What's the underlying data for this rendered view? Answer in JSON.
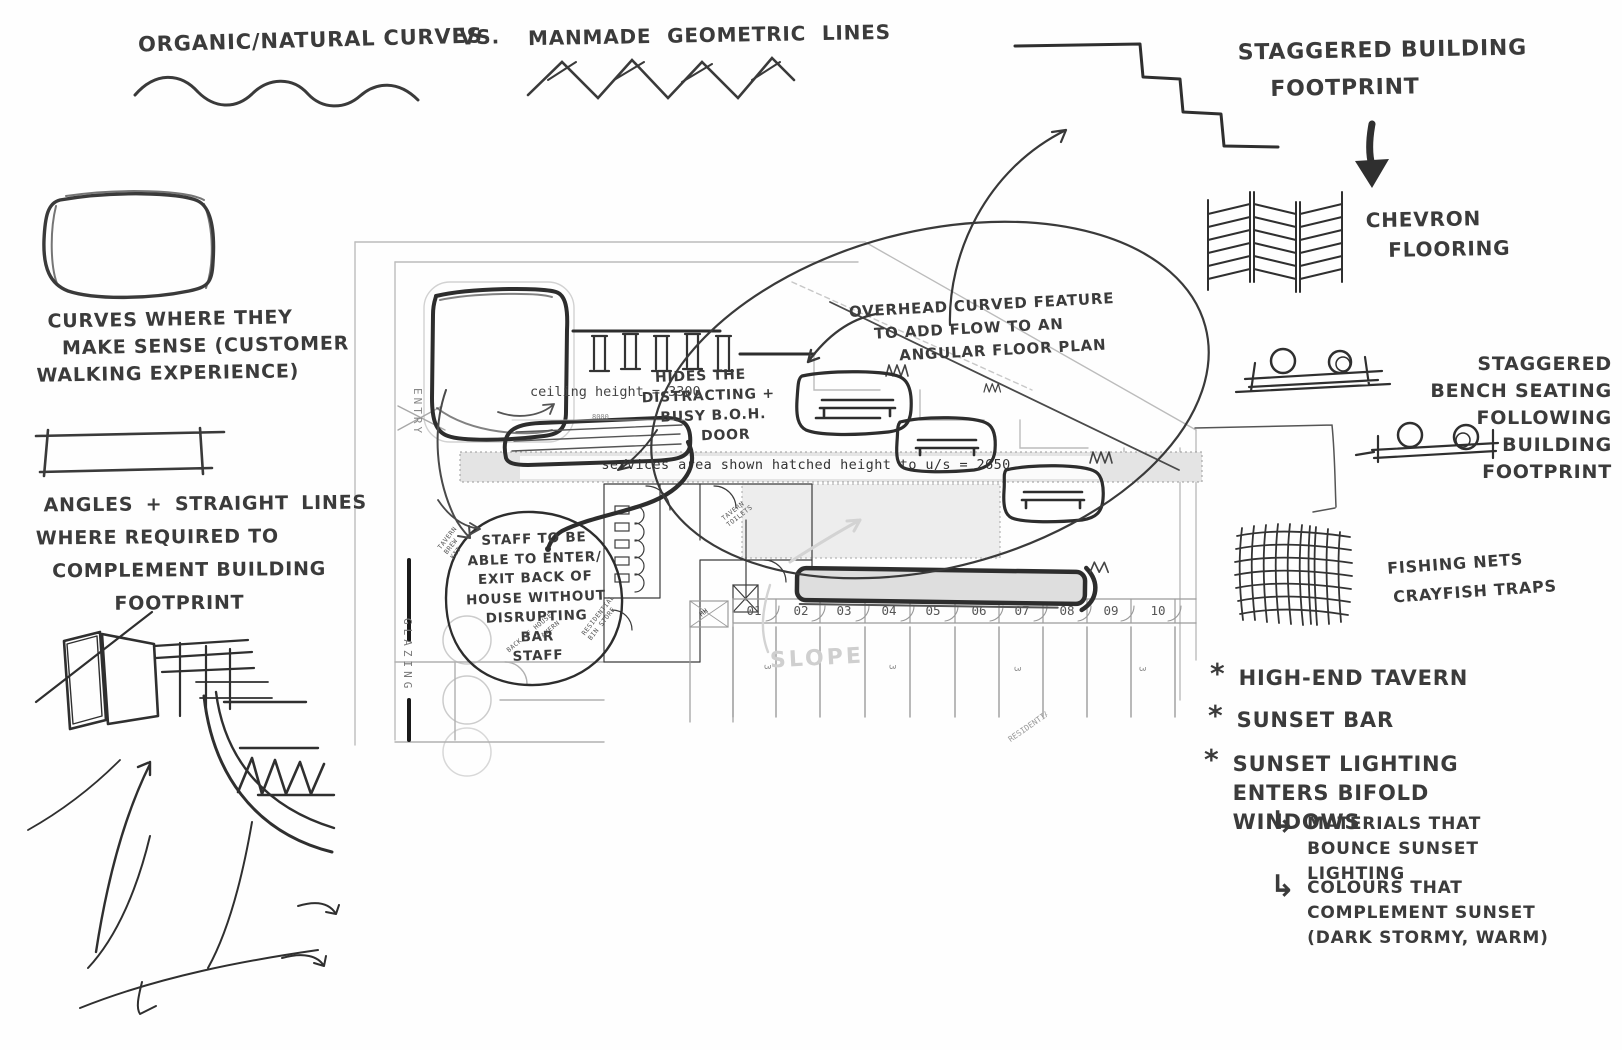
{
  "header": {
    "organic": "ORGANIC/NATURAL CURVES",
    "vs": "VS.",
    "manmade": "MANMADE GEOMETRIC LINES"
  },
  "left": {
    "curves_lines": [
      "CURVES WHERE THEY",
      "MAKE SENSE (CUSTOMER",
      "WALKING EXPERIENCE)"
    ],
    "angles_lines": [
      "ANGLES + STRAIGHT LINES",
      "WHERE REQUIRED TO",
      "COMPLEMENT BUILDING",
      "FOOTPRINT"
    ]
  },
  "right": {
    "staggered_building_lines": [
      "STAGGERED BUILDING",
      "FOOTPRINT"
    ],
    "chevron_lines": [
      "CHEVRON",
      "FLOORING"
    ],
    "bench_lines": [
      "STAGGERED",
      "BENCH SEATING",
      "FOLLOWING",
      "BUILDING",
      "FOOTPRINT"
    ],
    "nets_lines": [
      "FISHING NETS",
      "CRAYFISH TRAPS"
    ],
    "bullets": [
      {
        "marker": "*",
        "text": "HIGH-END TAVERN"
      },
      {
        "marker": "*",
        "text": "SUNSET BAR"
      },
      {
        "marker": "*",
        "text": "SUNSET LIGHTING ENTERS BIFOLD WINDOWS"
      }
    ],
    "sub_bullets": [
      {
        "marker": "↳",
        "text": "MATERIALS THAT BOUNCE SUNSET LIGHTING"
      },
      {
        "marker": "↳",
        "text": "COLOURS THAT COMPLEMENT SUNSET (DARK STORMY, WARM)"
      }
    ]
  },
  "annotations": {
    "overhead_lines": [
      "OVERHEAD CURVED FEATURE",
      "TO ADD FLOW TO AN",
      "ANGULAR FLOOR PLAN"
    ],
    "hides_lines": [
      "HIDES THE",
      "DISTRACTING +",
      "BUSY B.O.H.",
      "DOOR"
    ],
    "staff_lines": [
      "STAFF TO BE",
      "ABLE TO ENTER/",
      "EXIT BACK OF",
      "HOUSE WITHOUT",
      "DISRUPTING",
      "BAR",
      "STAFF"
    ]
  },
  "plan": {
    "ceiling_height": "ceiling height = 3300",
    "services_note": "services area shown hatched height to u/s = 2650",
    "dimension": "8000",
    "entry": "ENTRY",
    "glazing": "GLAZING",
    "slope": "SLOPE",
    "tavern_toilets_lines": [
      "TAVERN",
      "TOILETS"
    ],
    "tavern_brew_kit_lines": [
      "TAVERN",
      "BREW",
      "KIT"
    ],
    "back_of_house": "BACK OF HOUSE",
    "tavern": "TAVERN",
    "residential_bin_store_lines": [
      "RESIDENTIAL",
      "BIN STORE"
    ],
    "mh": "MH",
    "residential": "RESIDENTIAL",
    "stall_depth": "3",
    "stalls": [
      "01",
      "02",
      "03",
      "04",
      "05",
      "06",
      "07",
      "08",
      "09",
      "10"
    ]
  },
  "colors": {
    "ink": "#333333",
    "heavy_ink": "#2b2b2b",
    "plan_gray": "#b8b8b8",
    "hatch_fill": "#e6e6e6"
  }
}
